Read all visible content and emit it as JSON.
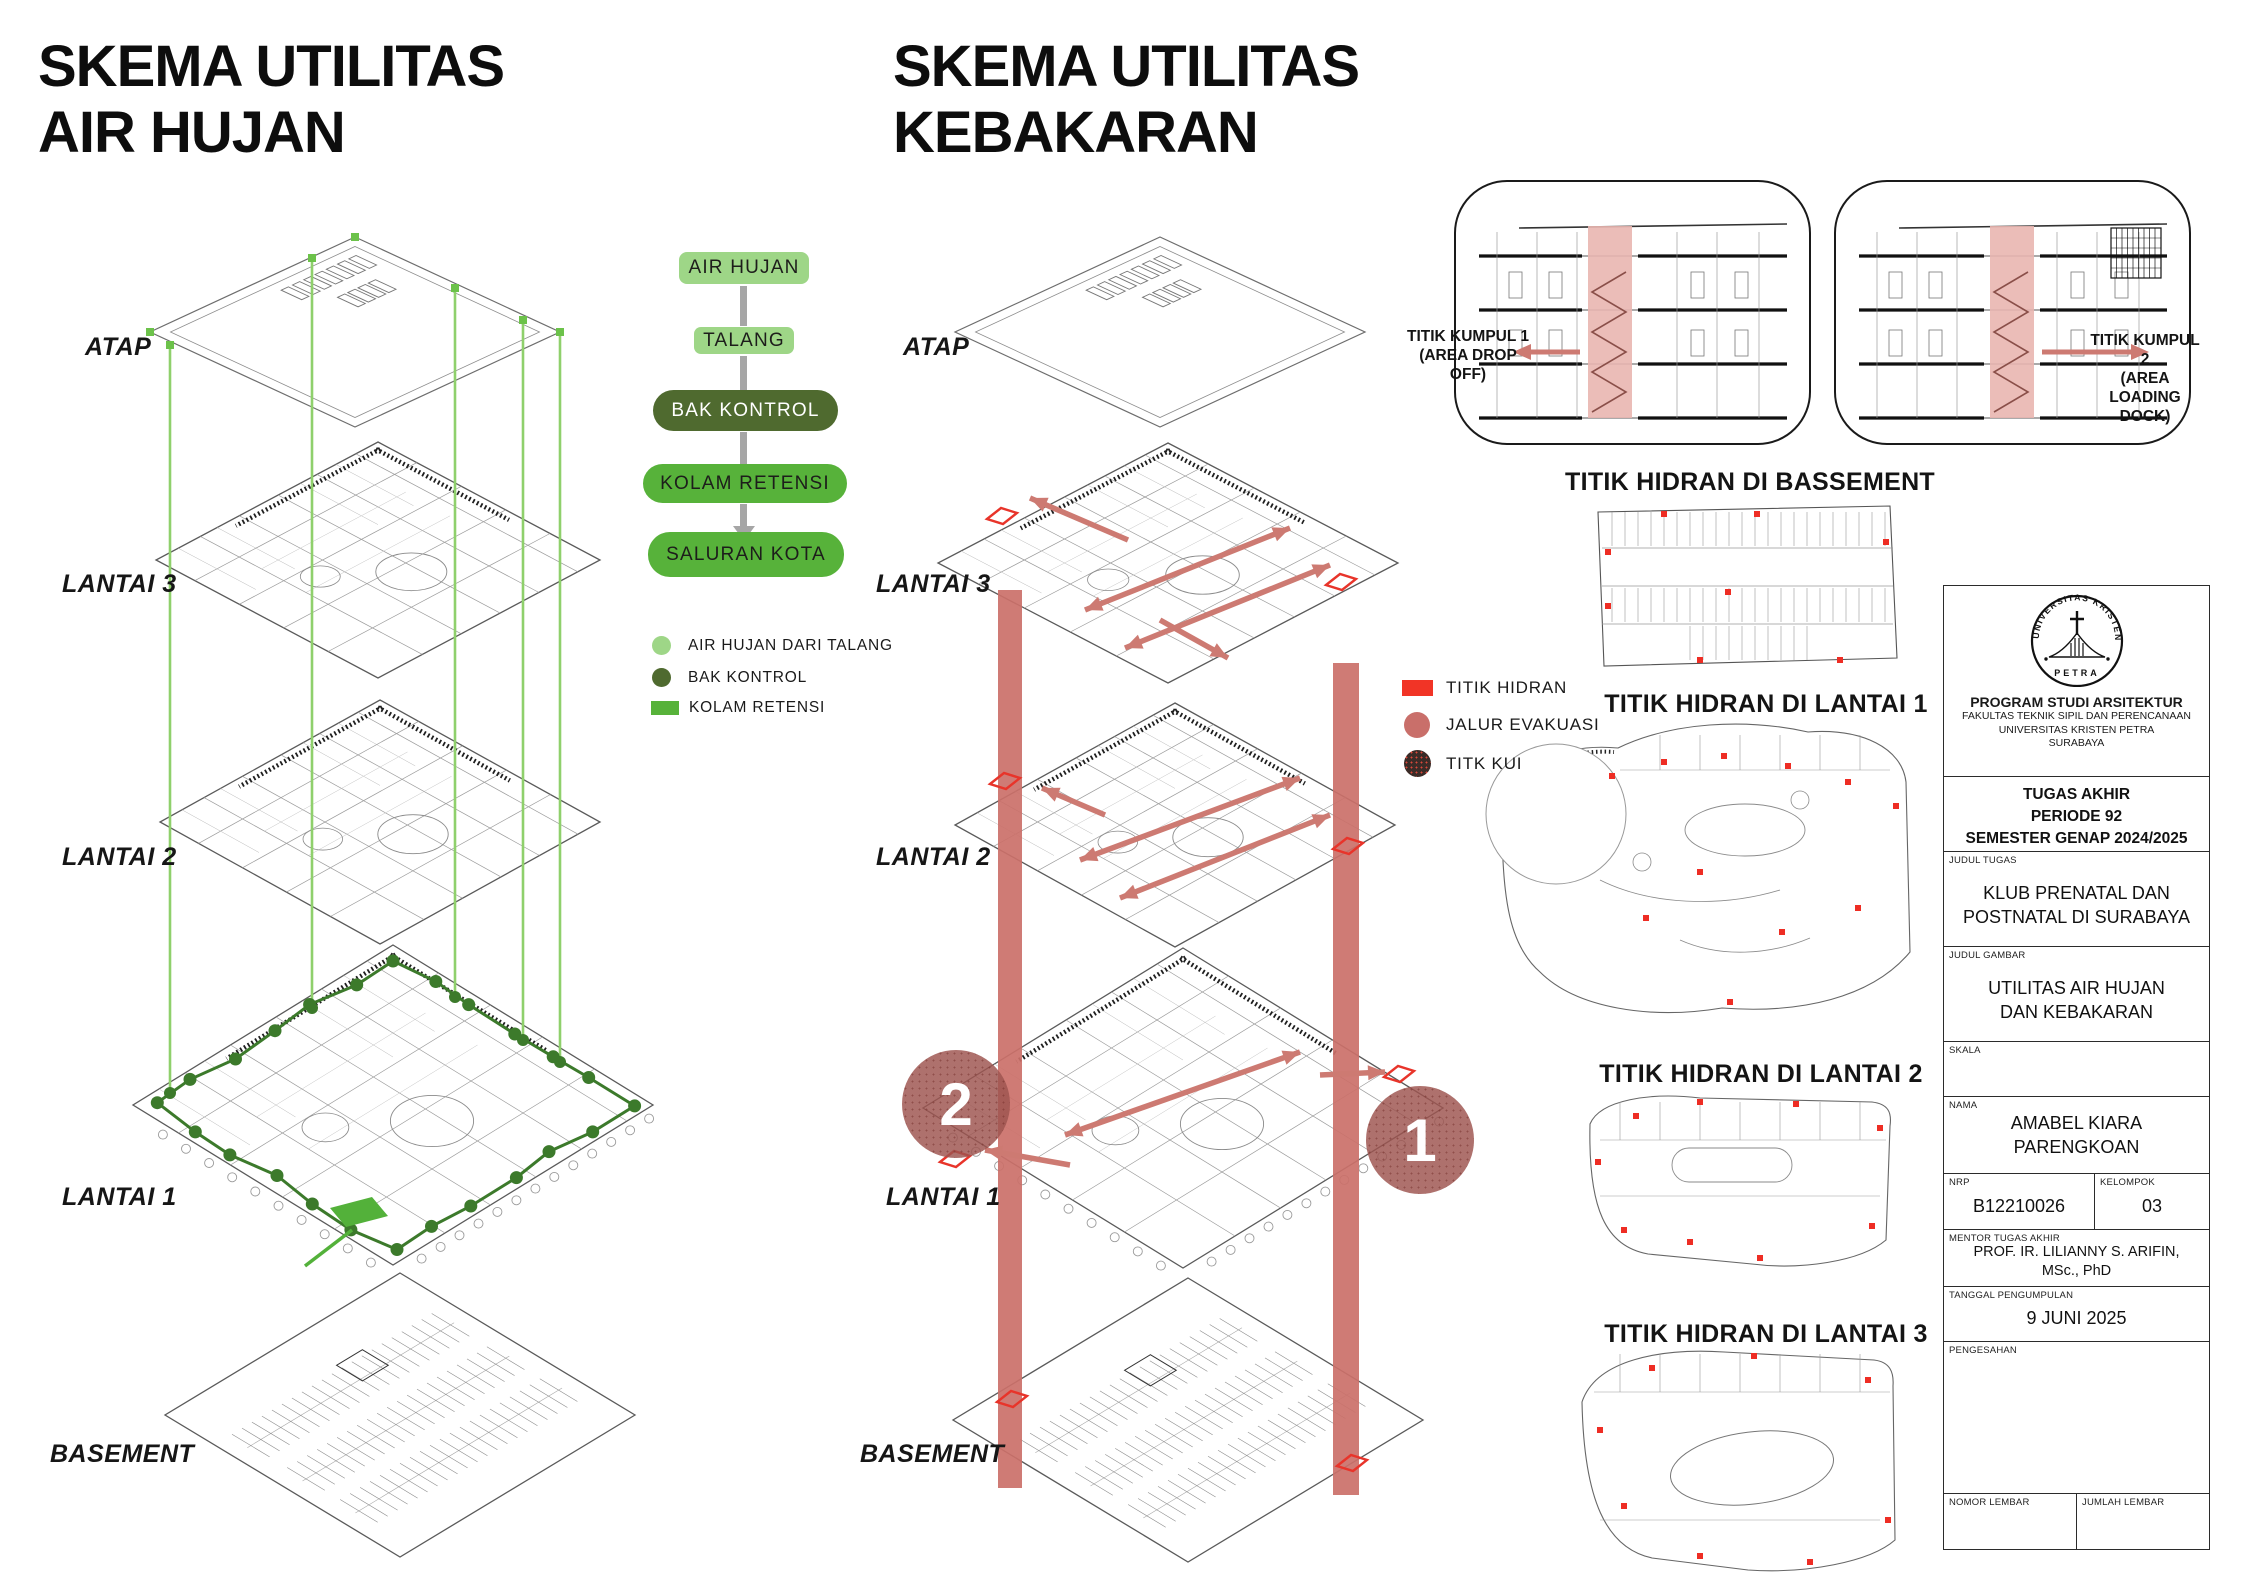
{
  "rain": {
    "title": "SKEMA UTILITAS\nAIR HUJAN",
    "floor_labels": [
      {
        "text": "ATAP"
      },
      {
        "text": "LANTAI 3"
      },
      {
        "text": "LANTAI 2"
      },
      {
        "text": "LANTAI 1"
      },
      {
        "text": "BASEMENT"
      }
    ],
    "flowchart": {
      "steps": [
        {
          "label": "AIR HUJAN",
          "color": "#9ed687"
        },
        {
          "label": "TALANG",
          "color": "#9ed687"
        },
        {
          "label": "BAK KONTROL",
          "color": "#4f6a2f"
        },
        {
          "label": "KOLAM RETENSI",
          "color": "#57b23a"
        },
        {
          "label": "SALURAN KOTA",
          "color": "#57b23a"
        }
      ],
      "legend": [
        {
          "label": "AIR HUJAN DARI TALANG",
          "color": "#9ed687",
          "shape": "circle"
        },
        {
          "label": "BAK KONTROL",
          "color": "#4f6a2f",
          "shape": "circle"
        },
        {
          "label": "KOLAM RETENSI",
          "color": "#57b23a",
          "shape": "square"
        }
      ]
    }
  },
  "fire": {
    "title": "SKEMA UTILITAS\nKEBAKARAN",
    "floor_labels": [
      {
        "text": "ATAP"
      },
      {
        "text": "LANTAI 3"
      },
      {
        "text": "LANTAI 2"
      },
      {
        "text": "LANTAI 1"
      },
      {
        "text": "BASEMENT"
      }
    ],
    "legend": [
      {
        "label": "TITIK HIDRAN",
        "color": "#f13426",
        "shape": "square"
      },
      {
        "label": "JALUR EVAKUASI",
        "color": "#c96f6a",
        "shape": "circle"
      },
      {
        "label": "TITK KUI",
        "color": "#3a2b27",
        "shape": "dotted-circle"
      }
    ],
    "markers": [
      {
        "number": "2"
      },
      {
        "number": "1"
      }
    ],
    "sections": [
      {
        "label": "TITIK KUMPUL 1\n(AREA DROP\nOFF)",
        "arrow": "left"
      },
      {
        "label": "TITIK KUMPUL 2\n(AREA LOADING\nDOCK)",
        "arrow": "right"
      }
    ],
    "hydrant_plans": [
      {
        "title": "TITIK HIDRAN DI BASSEMENT"
      },
      {
        "title": "TITIK HIDRAN DI LANTAI 1"
      },
      {
        "title": "TITIK HIDRAN DI LANTAI 2"
      },
      {
        "title": "TITIK HIDRAN DI LANTAI 3"
      }
    ]
  },
  "title_block": {
    "logo_top": "UNIVERSITAS KRISTEN",
    "logo_bottom": "PETRA",
    "program": "PROGRAM STUDI ARSITEKTUR",
    "faculty": "FAKULTAS TEKNIK SIPIL DAN PERENCANAAN",
    "university": "UNIVERSITAS KRISTEN PETRA",
    "city": "SURABAYA",
    "periode": "TUGAS AKHIR\nPERIODE 92\nSEMESTER GENAP 2024/2025",
    "judul_tugas_label": "JUDUL TUGAS",
    "judul_tugas": "KLUB PRENATAL DAN\nPOSTNATAL DI SURABAYA",
    "judul_gambar_label": "JUDUL GAMBAR",
    "judul_gambar": "UTILITAS AIR HUJAN\nDAN KEBAKARAN",
    "skala_label": "SKALA",
    "nama_label": "NAMA",
    "nama": "AMABEL KIARA\nPARENGKOAN",
    "nrp_label": "NRP",
    "nrp": "B12210026",
    "kelompok_label": "KELOMPOK",
    "kelompok": "03",
    "mentor_label": "MENTOR TUGAS AKHIR",
    "mentor": "PROF. IR. LILIANNY S. ARIFIN,\nMSc., PhD",
    "tanggal_label": "TANGGAL PENGUMPULAN",
    "tanggal": "9 JUNI 2025",
    "pengesahan_label": "PENGESAHAN",
    "nomor_lembar_label": "NOMOR LEMBAR",
    "jumlah_lembar_label": "JUMLAH LEMBAR"
  }
}
